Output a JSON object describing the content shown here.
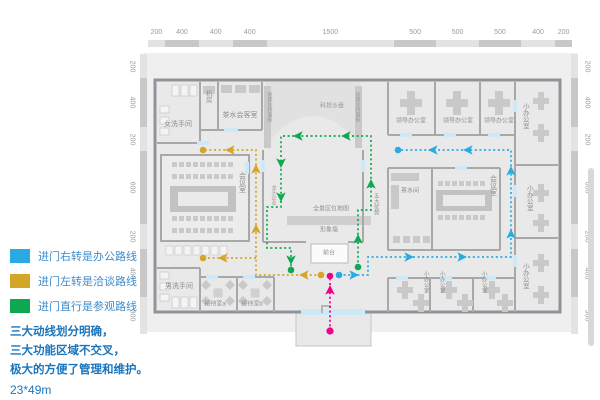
{
  "legend": {
    "items": [
      {
        "color": "#29ABE2",
        "label": "进门右转是办公路线"
      },
      {
        "color": "#D5A527",
        "label": "进门左转是洽谈路线"
      },
      {
        "color": "#0EA850",
        "label": "进门直行是参观路线"
      }
    ],
    "notes": [
      "三大动线划分明确，",
      "三大功能区域不交叉，",
      "极大的方便了管理和维护。"
    ],
    "size_note": "23*49m"
  },
  "rulers": {
    "top": [
      "200",
      "400",
      "400",
      "400",
      "1500",
      "500",
      "500",
      "500",
      "400",
      "200"
    ],
    "left": [
      "200",
      "400",
      "200",
      "600",
      "200",
      "400",
      "300"
    ],
    "right": [
      "200",
      "400",
      "200",
      "600",
      "200",
      "400",
      "300"
    ]
  },
  "rooms": {
    "women_restroom": "女洗手间",
    "machine_room": "机房",
    "tea_lounge": "茶水会客室",
    "tech_sandtable": "科技沙盘",
    "policy_board": "政策扶持展板",
    "leading_enterprise": "龙头企业",
    "five_advantages": "五大优势",
    "panorama_map": "全景区位地图",
    "image_wall": "形象墙",
    "front_desk": "前台",
    "meeting_room": "会议室",
    "men_restroom": "男洗手间",
    "reception_a": "接待室a",
    "reception_b": "接待室b",
    "tea_room": "茶水间",
    "leader_office": "领导办公室",
    "small_office": "小办公室"
  },
  "route_colors": {
    "office": "#29ABE2",
    "negotiation": "#D5A527",
    "tour": "#0EA850",
    "entrance": "#EC008C"
  }
}
